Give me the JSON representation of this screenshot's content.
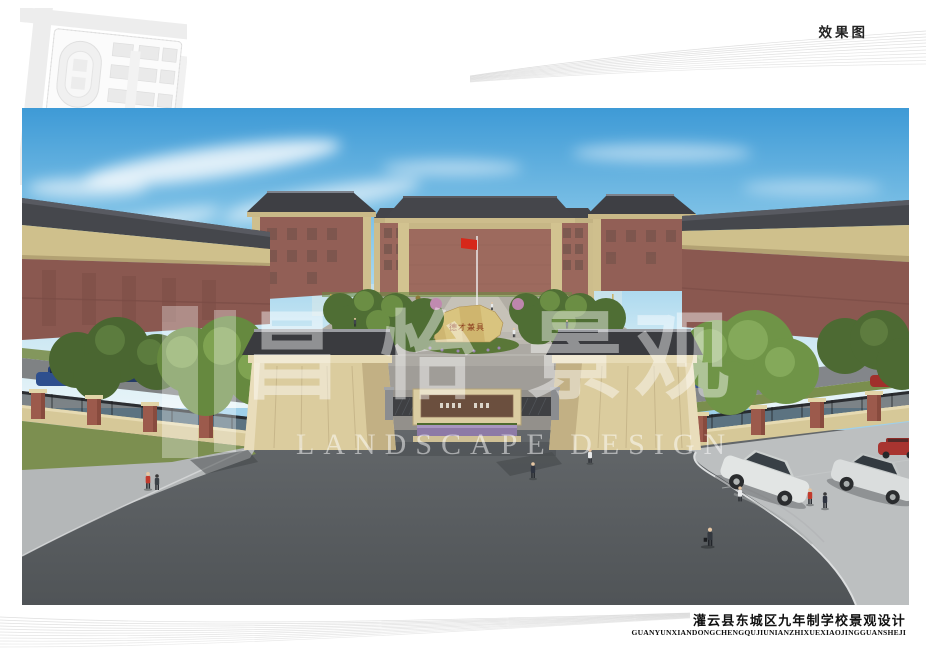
{
  "sheet": {
    "type_label": "效果图"
  },
  "site_plan": {
    "marker_color": "#c8202d"
  },
  "watermark": {
    "chars": [
      "昌",
      "怡",
      "景",
      "观"
    ],
    "en": "LANDSCAPE DESIGN"
  },
  "scene": {
    "stone_inscription": "德才兼具",
    "flag_color": "#d6281a"
  },
  "title_block": {
    "cn": "灌云县东城区九年制学校景观设计",
    "pinyin": "GUANYUNXIANDONGCHENGQUJIUNIANZHIXUEXIAOJINGGUANSHEJI"
  },
  "colors": {
    "sky_top": "#3e9ad6",
    "sky_horizon": "#d8eef7",
    "roof": "#45464b",
    "brick": "#96635a",
    "trim_beige": "#cfc08c",
    "pylon_beige": "#dbcc9e",
    "road": "#5b5f62",
    "pavement": "#b9bcbc",
    "lawn": "#7c8f50",
    "tree_green": "#66893f",
    "flag_red": "#d6281a",
    "marker_red": "#c8202d"
  }
}
